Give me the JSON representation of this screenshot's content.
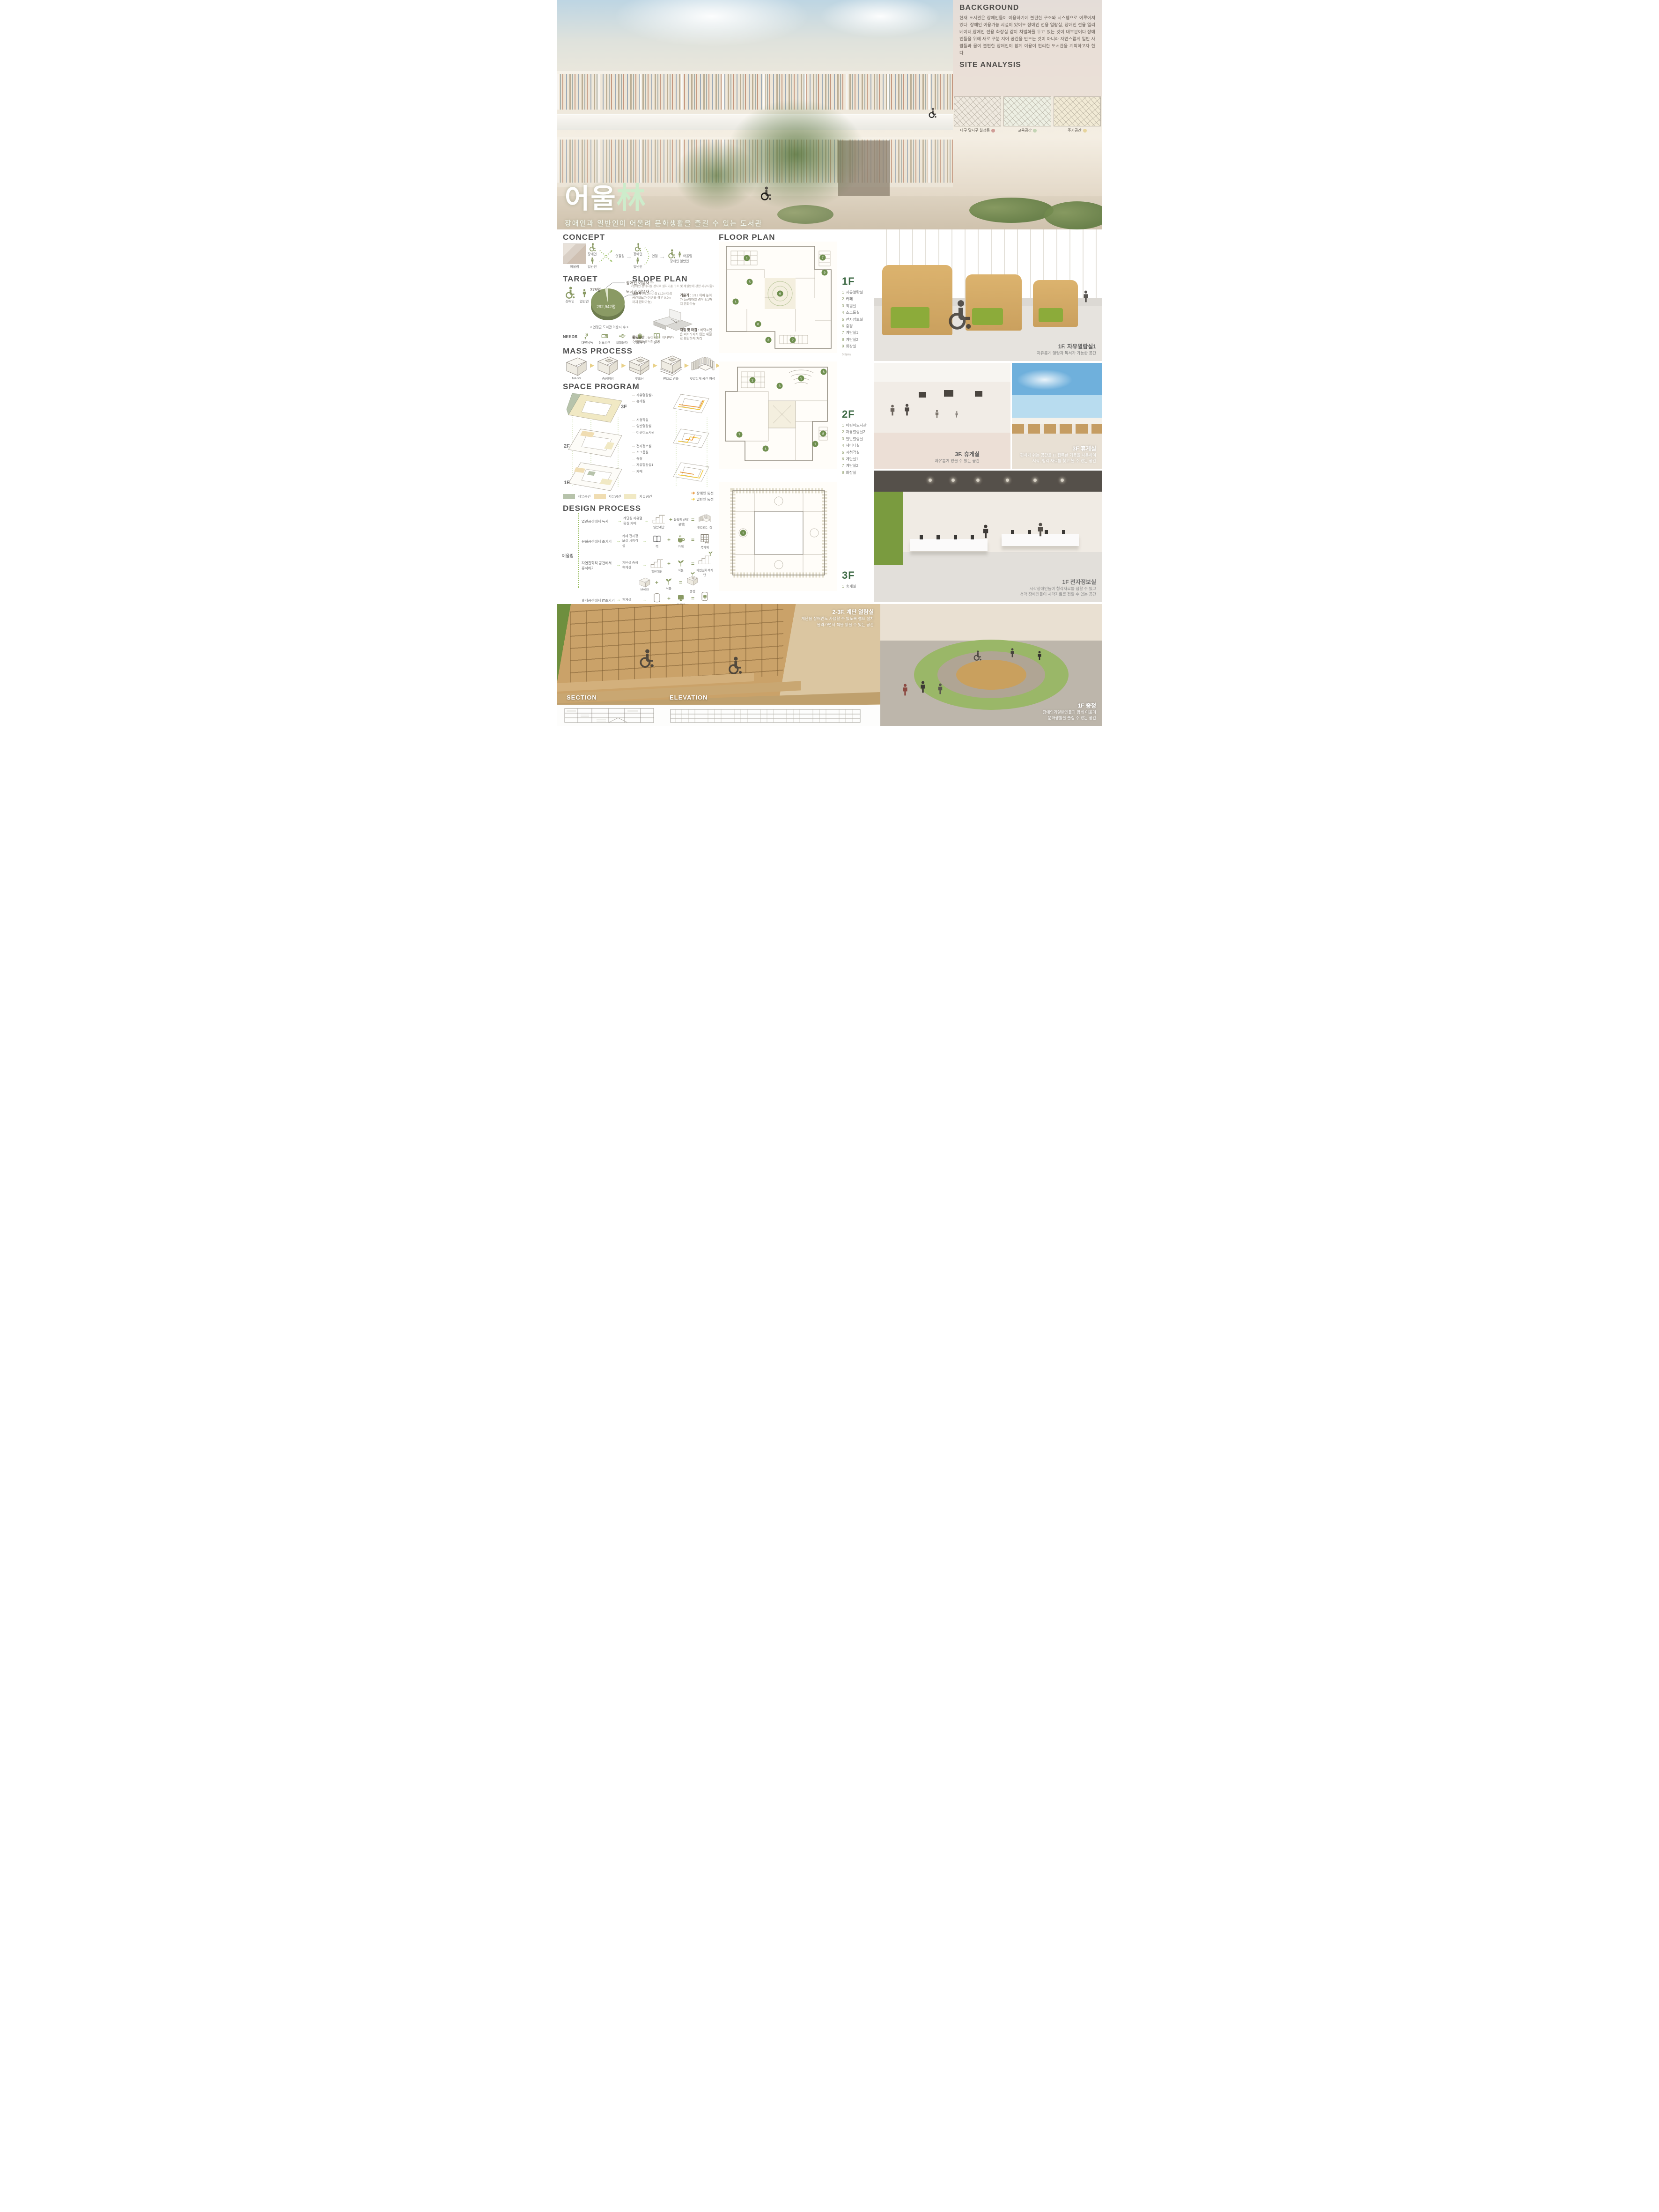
{
  "hero": {
    "title_main": "어울",
    "title_hanja": "林",
    "subtitle": "장애인과 일반인이 어울려 문화생활을 즐길 수 있는 도서관"
  },
  "background": {
    "heading": "BACKGROUND",
    "body": "현재 도서관은 장애인들이 이용하기에 불편한 구조와 시스템으로 이루어져있다. 장애인 이용가능 시설이 있어도 장애인 전용 열람실, 장애인 전용 엘리베이터,장애인 전용 화장실 같이 차별화를 두고 있는 것이 대부분이다.장애인들을 위해 새로 구분 지어 공간을 만드는 것이 아니라 자연스럽게 일반 사람들과 몸이 불편한 장애인이 함께 이용이 편리한 도서관을 계획하고자 한다."
  },
  "site_analysis": {
    "heading": "SITE ANALYSIS",
    "maps": [
      {
        "label": "대구 달서구 월성동",
        "dot": "#cf9d97",
        "tint": "#efe9df"
      },
      {
        "label": "교육공간",
        "dot": "#c3d4b4",
        "tint": "#edefe3"
      },
      {
        "label": "주거공간",
        "dot": "#e6d49c",
        "tint": "#f1ead5"
      }
    ]
  },
  "concept": {
    "heading": "CONCEPT",
    "photo_label": "어울림",
    "disabled": "장애인",
    "general": "일반인",
    "cross": "엇갈림",
    "connect": "연결",
    "merge": "어울림",
    "merge_sub": "장애인  일반인"
  },
  "target": {
    "heading": "TARGET",
    "disabled": "장애인",
    "general": "일반인",
    "pie": {
      "slice_value": "375명",
      "slice_label": "장애인 이용자 수",
      "main_label": "도서관 이용자 수",
      "main_value": "292,942명",
      "caption": "< 연평균 도서관  이용자 수 >"
    },
    "needs_label": "NEEDS",
    "needs": [
      {
        "label": "대면낭독",
        "icon_ref": "#sym-speech",
        "icon_name": "reading-aloud-icon"
      },
      {
        "label": "정보검색",
        "icon_ref": "#sym-tablet",
        "icon_name": "info-search-icon"
      },
      {
        "label": "확대문자",
        "icon_ref": "#sym-largetext",
        "icon_name": "large-text-icon"
      },
      {
        "label": "수화통역",
        "icon_ref": "#sym-hand",
        "icon_name": "sign-language-icon"
      },
      {
        "label": "점역",
        "icon_ref": "#sym-book",
        "icon_name": "braille-icon"
      }
    ]
  },
  "slope_plan": {
    "heading": "SLOPE PLAN",
    "note": "<장애인  편의시설 경사로 설치기준 구조 및 재질등에 관한 세부사항>",
    "specs": [
      {
        "term": "유효폭 :",
        "desc": "1.2m이상 (1.2m이상 공간확보가 어려울 경우 0.9m까지 완화가능)"
      },
      {
        "term": "기울기 :",
        "desc": "1/12 이하 높이가 1m이하일 경우 8/1까지 완화가능"
      },
      {
        "term": "활동공간 :",
        "desc": "높이 0.7m 이내마다 수평면의 휴식참 설치"
      },
      {
        "term": "재질 및 마감 :",
        "desc": "바닥표면은 미끄러지지 않는 재질로 평탄하게 처리"
      }
    ]
  },
  "mass_process": {
    "heading": "MASS PROCESS",
    "steps": [
      {
        "label": "MASS",
        "icon_ref": "#sym-cube"
      },
      {
        "label": "중정형성",
        "icon_ref": "#sym-cubehole"
      },
      {
        "label": "루프선",
        "icon_ref": "#sym-cuberoof"
      },
      {
        "label": "면으로 변화",
        "icon_ref": "#sym-cubeslab"
      },
      {
        "label": "엇갈리게 공간 형성",
        "icon_ref": "#sym-slatring"
      }
    ]
  },
  "space_program": {
    "heading": "SPACE PROGRAM",
    "floors": [
      {
        "tag": "3F",
        "rooms": [
          "자유열람실2",
          "휴게실"
        ]
      },
      {
        "tag": "2F",
        "rooms": [
          "시청각실",
          "일반열람실",
          "어린이도서관"
        ]
      },
      {
        "tag": "1F",
        "rooms": [
          "전자정보실",
          "소그룹실",
          "중정",
          "자유열람실1",
          "카페"
        ]
      }
    ],
    "legend": [
      {
        "label": "자유공간",
        "color": "#b7c3ab"
      },
      {
        "label": "자유공간",
        "color": "#f0ddb2"
      },
      {
        "label": "자유공간",
        "color": "#f1e9c4"
      }
    ],
    "flows": [
      {
        "label": "장애인 동선",
        "color": "#e78f2e"
      },
      {
        "label": "일반인 동선",
        "color": "#f2c83c"
      }
    ]
  },
  "design_process": {
    "heading": "DESIGN PROCESS",
    "root": "어울림",
    "rows": [
      {
        "activity": "열린공간에서 독서",
        "spaces": "계단실 자유열람실 카페",
        "a": "일반계단",
        "b": "움직임 (공간 분할)",
        "result": "엇갈리는 층"
      },
      {
        "activity": "문화공간에서 즐기기",
        "spaces": "카페 전자정보실 시청각실",
        "a": "책",
        "b": "카페",
        "result": "북카페"
      },
      {
        "activity": "자연친화적 공간에서 휴식하기",
        "spaces": "계단실 중정 휴게실",
        "a": "일반계단",
        "b": "식물",
        "result": "자연친화적계단"
      },
      {
        "activity": "",
        "spaces": "",
        "a": "MASS",
        "b": "식물",
        "result": "중정"
      },
      {
        "activity": "휴게공간에서 IT즐기기",
        "spaces": "휴게실",
        "a": "기둥",
        "b": "컴퓨터",
        "result": "옥상휴게실"
      }
    ]
  },
  "floor_plan": {
    "heading": "FLOOR PLAN",
    "scale": "0   5(m)",
    "floors": [
      {
        "tag": "1F",
        "rooms": [
          {
            "num": "1",
            "name": "자유열람실"
          },
          {
            "num": "2",
            "name": "카페"
          },
          {
            "num": "3",
            "name": "직원실"
          },
          {
            "num": "4",
            "name": "소그룹실"
          },
          {
            "num": "5",
            "name": "전자정보실"
          },
          {
            "num": "6",
            "name": "중정"
          },
          {
            "num": "7",
            "name": "계단실1"
          },
          {
            "num": "8",
            "name": "계단실2"
          },
          {
            "num": "9",
            "name": "화장실"
          }
        ]
      },
      {
        "tag": "2F",
        "rooms": [
          {
            "num": "1",
            "name": "어린이도서관"
          },
          {
            "num": "2",
            "name": "자유열람실2"
          },
          {
            "num": "3",
            "name": "일반열람실"
          },
          {
            "num": "4",
            "name": "세미나실"
          },
          {
            "num": "5",
            "name": "시청각실"
          },
          {
            "num": "6",
            "name": "계단실1"
          },
          {
            "num": "7",
            "name": "계단실2"
          },
          {
            "num": "8",
            "name": "화장실"
          }
        ]
      },
      {
        "tag": "3F",
        "rooms": [
          {
            "num": "1",
            "name": "휴게실"
          }
        ]
      }
    ]
  },
  "renders": {
    "reading": {
      "title": "1F. 자유열람실1",
      "line1": "자유롭게 열람과 독서가 가능한 공간"
    },
    "lounge_a": {
      "title": "3F. 휴게실",
      "line1": "자유롭게 있을 수 있는 공간"
    },
    "lounge_b": {
      "title": "3F 휴게실",
      "line1": "편하게 쉬는 공간을 IT 접목한 기둥을 사용하여",
      "line2": "시각, 청각 자료를 찾고 볼 수 있는 공간"
    },
    "digital": {
      "title": "1F 전자정보실",
      "line1": "시각장애인들이 청각자료를 접할 수 있고",
      "line2": "청각 장애인들이 시각자료를 접할 수 있는 공간"
    },
    "stair": {
      "title": "2-3F. 계단 열람실",
      "line1": "계단을 장애인도 사용할 수 있도록 램프 설치",
      "line2": "올라가면서 책을 읽을 수 있는 공간"
    },
    "courtyard": {
      "title": "1F 중정",
      "line1": "장애인과일반인들과 함께 어울려",
      "line2": "문화생활을 즐길 수 있는 공간"
    }
  },
  "section": {
    "heading": "SECTION"
  },
  "elevation": {
    "heading": "ELEVATION"
  }
}
